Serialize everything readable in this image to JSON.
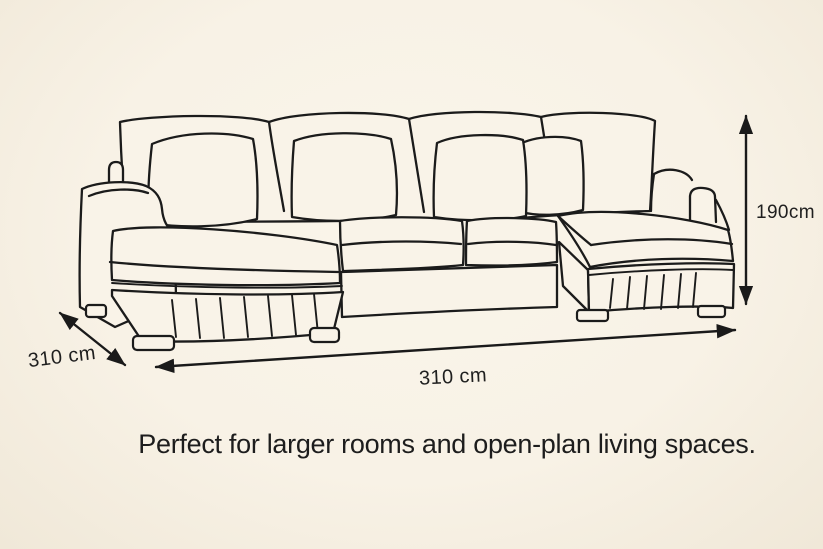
{
  "page": {
    "background_color": "#f8f2e6",
    "line_color": "#1b1b1b",
    "text_color": "#1f1f1f"
  },
  "diagram": {
    "subject": "u-shaped sectional sofa with double chaise, four back cushions and four pillows, pleated base skirt",
    "dimensions": {
      "height_label": "190cm",
      "depth_label": "310 cm",
      "width_label": "310 cm"
    },
    "caption": "Perfect for larger rooms and open-plan living spaces."
  }
}
